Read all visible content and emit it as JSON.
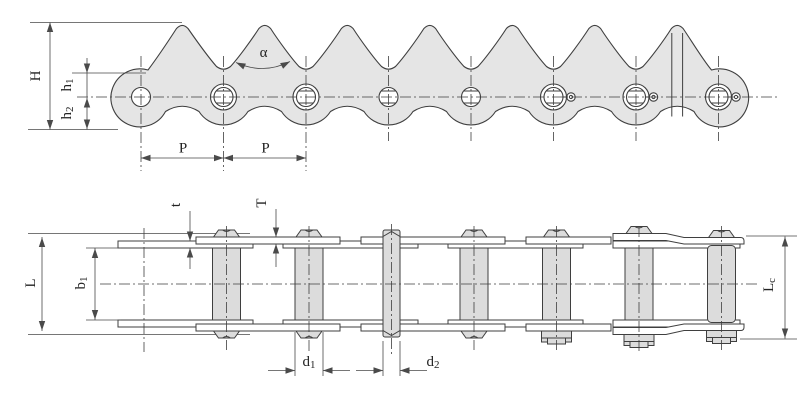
{
  "diagram": {
    "kind": "technical-engineering-drawing",
    "subject": "sharp-top plate conveyor roller chain, side elevation and plan view",
    "colors": {
      "plate_fill": "#e5e5e5",
      "hardware_fill": "#dcdcdc",
      "line": "#3f3f3f",
      "dim": "#4a4a4a",
      "background": "#ffffff"
    },
    "top_view": {
      "tooth_count": 7,
      "pin_count": 8,
      "dimensions": {
        "H": {
          "text": "H",
          "sub": ""
        },
        "h1": {
          "text": "h",
          "sub": "1"
        },
        "h2": {
          "text": "h",
          "sub": "2"
        },
        "P_left": {
          "text": "P",
          "sub": ""
        },
        "P_right": {
          "text": "P",
          "sub": ""
        },
        "alpha": {
          "text": "α",
          "sub": ""
        }
      }
    },
    "bottom_view": {
      "roller_count": 7,
      "dimensions": {
        "t": {
          "text": "t",
          "sub": ""
        },
        "T": {
          "text": "T",
          "sub": ""
        },
        "L": {
          "text": "L",
          "sub": ""
        },
        "b1": {
          "text": "b",
          "sub": "1"
        },
        "d1": {
          "text": "d",
          "sub": "1"
        },
        "d2": {
          "text": "d",
          "sub": "2"
        },
        "Lc": {
          "text": "L",
          "sub": "c"
        }
      }
    }
  }
}
